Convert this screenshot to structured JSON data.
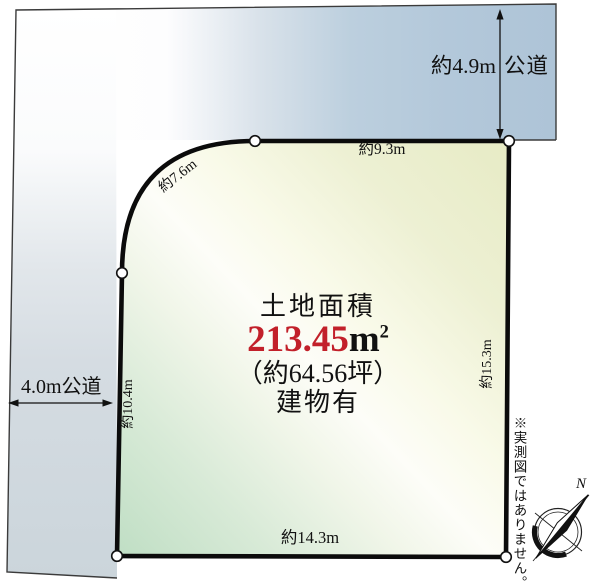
{
  "diagram": {
    "area_section": {
      "title": "土地面積",
      "area_value": "213.45",
      "area_unit": "m",
      "area_unit_sup": "2",
      "area_tsubo": "（約64.56坪）",
      "building_status": "建物有"
    },
    "boundary_dimensions": {
      "top": "約9.3m",
      "corner": "約7.6m",
      "left": "約10.4m",
      "right": "約15.3m",
      "bottom": "約14.3m"
    },
    "roads": {
      "top_road_width": "約4.9m",
      "top_road_type": "公道",
      "left_road_label": "4.0m公道"
    },
    "compass_north": "N",
    "disclaimer": "※実測図ではありません。",
    "colors": {
      "area_value_red": "#c2202a",
      "road_blue": "#aec4d7",
      "road_gray": "#cbd5db",
      "plot_yellow_green": "#e7ebc5",
      "plot_green": "#bfdec4",
      "outline_black": "#0b0b0b"
    }
  }
}
